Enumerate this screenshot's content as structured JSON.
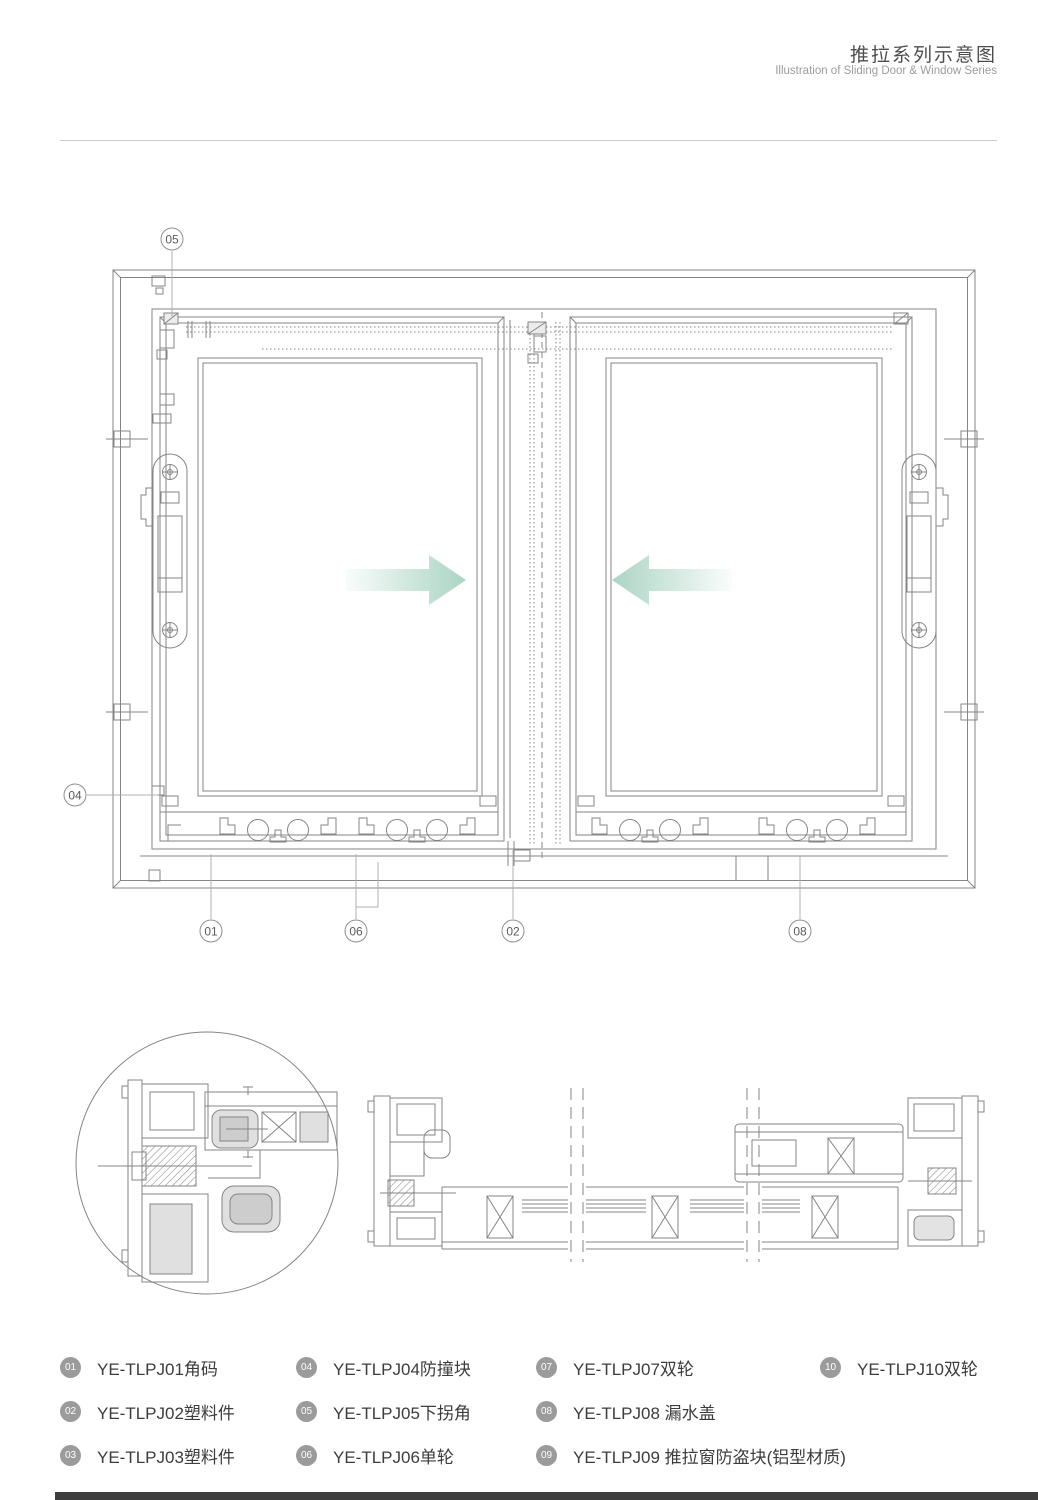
{
  "header": {
    "title_zh": "推拉系列示意图",
    "title_en": "Illustration of Sliding Door & Window Series"
  },
  "diagram": {
    "arrow_color": "#a6d2c0",
    "line_color": "#858585",
    "callouts": [
      {
        "id": "05",
        "x": 172,
        "y": 239
      },
      {
        "id": "04",
        "x": 75,
        "y": 795
      },
      {
        "id": "01",
        "x": 211,
        "y": 931
      },
      {
        "id": "06",
        "x": 356,
        "y": 931
      },
      {
        "id": "02",
        "x": 513,
        "y": 931
      },
      {
        "id": "08",
        "x": 800,
        "y": 931
      }
    ]
  },
  "legend": {
    "badge_color": "#9b9b9b",
    "columns": [
      {
        "items": [
          {
            "num": "01",
            "label": "YE-TLPJ01角码"
          },
          {
            "num": "02",
            "label": "YE-TLPJ02塑料件"
          },
          {
            "num": "03",
            "label": "YE-TLPJ03塑料件"
          }
        ]
      },
      {
        "items": [
          {
            "num": "04",
            "label": "YE-TLPJ04防撞块"
          },
          {
            "num": "05",
            "label": "YE-TLPJ05下拐角"
          },
          {
            "num": "06",
            "label": "YE-TLPJ06单轮"
          }
        ]
      },
      {
        "items": [
          {
            "num": "07",
            "label": "YE-TLPJ07双轮"
          },
          {
            "num": "08",
            "label": "YE-TLPJ08 漏水盖"
          },
          {
            "num": "09",
            "label": "YE-TLPJ09 推拉窗防盗块(铝型材质)"
          }
        ]
      },
      {
        "items": [
          {
            "num": "10",
            "label": "YE-TLPJ10双轮"
          }
        ]
      }
    ]
  },
  "footer": {
    "bar_color": "#3d3d3d"
  }
}
